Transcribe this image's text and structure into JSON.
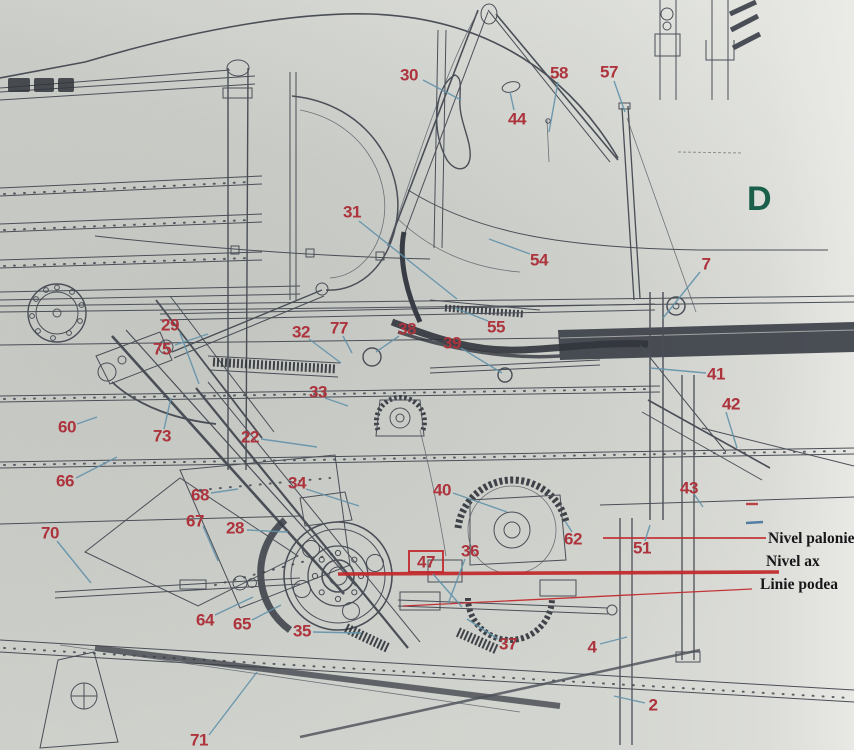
{
  "page": {
    "type": "scanned technical drawing, aircraft fuselage / cockpit structure side view with numbered part callouts",
    "section_letter": "D"
  },
  "colors": {
    "callout_red": "#b5313b",
    "leader_blue": "#5f93ad",
    "reference_red": "#cc2428",
    "label_black": "#17171a",
    "letter_green": "#15604a",
    "paper": "#d3d5d0",
    "ink": "#4a4f58"
  },
  "callouts": [
    {
      "n": "30",
      "x": 409,
      "y": 75,
      "leader": [
        423,
        80,
        461,
        100
      ]
    },
    {
      "n": "44",
      "x": 517,
      "y": 119,
      "leader": [
        514,
        110,
        510,
        92
      ]
    },
    {
      "n": "58",
      "x": 559,
      "y": 73,
      "leader": [
        558,
        82,
        549,
        132
      ]
    },
    {
      "n": "57",
      "x": 609,
      "y": 72,
      "leader": [
        614,
        81,
        625,
        112
      ]
    },
    {
      "n": "31",
      "x": 352,
      "y": 212,
      "leader": [
        359,
        221,
        457,
        299
      ]
    },
    {
      "n": "54",
      "x": 539,
      "y": 260,
      "leader": [
        530,
        254,
        489,
        239
      ]
    },
    {
      "n": "7",
      "x": 706,
      "y": 264,
      "leader": [
        700,
        272,
        663,
        318
      ]
    },
    {
      "n": "29",
      "x": 170,
      "y": 325,
      "leader": [
        180,
        333,
        199,
        384
      ]
    },
    {
      "n": "75",
      "x": 162,
      "y": 349,
      "leader": [
        175,
        345,
        208,
        334
      ]
    },
    {
      "n": "32",
      "x": 301,
      "y": 332,
      "leader": [
        309,
        339,
        341,
        363
      ]
    },
    {
      "n": "77",
      "x": 339,
      "y": 328,
      "leader": [
        343,
        336,
        352,
        353
      ]
    },
    {
      "n": "38",
      "x": 407,
      "y": 329,
      "leader": [
        399,
        336,
        376,
        352
      ]
    },
    {
      "n": "55",
      "x": 496,
      "y": 327,
      "leader": [
        488,
        321,
        455,
        308
      ]
    },
    {
      "n": "39",
      "x": 452,
      "y": 343,
      "leader": [
        461,
        348,
        502,
        373
      ]
    },
    {
      "n": "41",
      "x": 716,
      "y": 374,
      "leader": [
        706,
        373,
        650,
        368
      ]
    },
    {
      "n": "42",
      "x": 731,
      "y": 404,
      "leader": [
        726,
        412,
        737,
        448
      ]
    },
    {
      "n": "33",
      "x": 318,
      "y": 392,
      "leader": [
        325,
        398,
        348,
        406
      ]
    },
    {
      "n": "60",
      "x": 67,
      "y": 427,
      "leader": [
        77,
        424,
        97,
        417
      ]
    },
    {
      "n": "73",
      "x": 162,
      "y": 436,
      "leader": [
        164,
        429,
        171,
        398
      ]
    },
    {
      "n": "22",
      "x": 250,
      "y": 437,
      "leader": [
        261,
        439,
        317,
        447
      ]
    },
    {
      "n": "34",
      "x": 297,
      "y": 483,
      "leader": [
        306,
        489,
        359,
        506
      ]
    },
    {
      "n": "40",
      "x": 442,
      "y": 490,
      "leader": [
        453,
        493,
        507,
        512
      ]
    },
    {
      "n": "66",
      "x": 65,
      "y": 481,
      "leader": [
        76,
        478,
        117,
        457
      ]
    },
    {
      "n": "68",
      "x": 200,
      "y": 495,
      "leader": [
        211,
        493,
        238,
        489
      ]
    },
    {
      "n": "67",
      "x": 195,
      "y": 521,
      "leader": [
        203,
        526,
        218,
        561
      ]
    },
    {
      "n": "28",
      "x": 235,
      "y": 528,
      "leader": [
        247,
        530,
        288,
        532
      ]
    },
    {
      "n": "70",
      "x": 50,
      "y": 533,
      "leader": [
        57,
        541,
        91,
        583
      ]
    },
    {
      "n": "43",
      "x": 689,
      "y": 488,
      "leader": [
        694,
        494,
        703,
        507
      ]
    },
    {
      "n": "62",
      "x": 573,
      "y": 539,
      "leader": [
        572,
        532,
        565,
        521
      ]
    },
    {
      "n": "51",
      "x": 642,
      "y": 548,
      "leader": [
        645,
        541,
        650,
        525
      ]
    },
    {
      "n": "36",
      "x": 470,
      "y": 551,
      "leader": [
        465,
        559,
        448,
        604
      ]
    },
    {
      "n": "47",
      "x": 426,
      "y": 562,
      "boxed": true,
      "leader": [
        433,
        574,
        462,
        607
      ]
    },
    {
      "n": "35",
      "x": 302,
      "y": 631,
      "leader": [
        313,
        632,
        361,
        633
      ]
    },
    {
      "n": "64",
      "x": 205,
      "y": 620,
      "leader": [
        215,
        615,
        253,
        597
      ]
    },
    {
      "n": "65",
      "x": 242,
      "y": 624,
      "leader": [
        252,
        620,
        281,
        605
      ]
    },
    {
      "n": "37",
      "x": 508,
      "y": 644,
      "leader": [
        498,
        639,
        467,
        619
      ]
    },
    {
      "n": "4",
      "x": 592,
      "y": 647,
      "leader": [
        600,
        644,
        627,
        637
      ]
    },
    {
      "n": "2",
      "x": 653,
      "y": 705,
      "leader": [
        645,
        703,
        614,
        696
      ]
    },
    {
      "n": "71",
      "x": 199,
      "y": 740,
      "leader": [
        209,
        735,
        257,
        672
      ]
    }
  ],
  "reference_lines": [
    {
      "name": "nivel-palonier",
      "label": "Nivel palonier",
      "line": [
        603,
        538,
        766,
        538
      ],
      "width": 1.8,
      "label_x": 768,
      "label_y": 543
    },
    {
      "name": "nivel-ax",
      "label": "Nivel ax",
      "line": [
        338,
        574,
        779,
        572
      ],
      "width": 3.6,
      "label_x": 766,
      "label_y": 566
    },
    {
      "name": "linie-podea",
      "label": "Linie podea",
      "line": [
        403,
        606,
        752,
        589
      ],
      "width": 1.3,
      "label_x": 760,
      "label_y": 589
    }
  ],
  "tick_marks": [
    {
      "x1": 746,
      "y1": 504,
      "x2": 758,
      "y2": 504,
      "color": "#c24045"
    },
    {
      "x1": 746,
      "y1": 523,
      "x2": 763,
      "y2": 522,
      "color": "#4f7fa6"
    }
  ]
}
